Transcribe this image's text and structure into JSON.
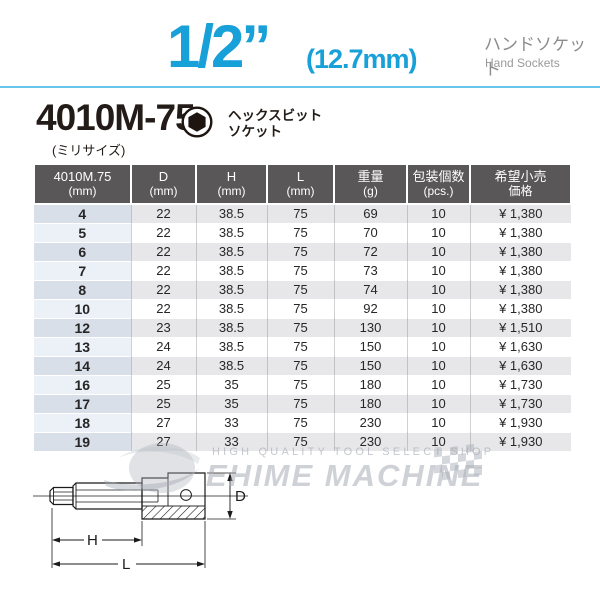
{
  "header": {
    "size_fraction": "1/2”",
    "size_mm": "(12.7mm)",
    "category_jp": "ハンドソケット",
    "category_en": "Hand Sockets",
    "accent_color": "#18a0d8",
    "rule_color": "#67c6ea"
  },
  "product": {
    "model": "4010M-75",
    "variant_note": "(ミリサイズ)",
    "type_line1": "ヘックスビット",
    "type_line2": "ソケット",
    "icon": "hex-bit-icon"
  },
  "table": {
    "header_bg": "#595757",
    "alt_row_color": "#e7e7e9",
    "first_col_colors": [
      "#d8dfe9",
      "#ebf1f7"
    ],
    "headers": [
      {
        "line1": "4010M.75",
        "line2": "(mm)"
      },
      {
        "line1": "D",
        "line2": "(mm)"
      },
      {
        "line1": "H",
        "line2": "(mm)"
      },
      {
        "line1": "L",
        "line2": "(mm)"
      },
      {
        "line1": "重量",
        "line2": "(g)"
      },
      {
        "line1": "包装個数",
        "line2": "(pcs.)"
      },
      {
        "line1": "希望小売",
        "line2": "価格"
      }
    ],
    "rows": [
      [
        "4",
        "22",
        "38.5",
        "75",
        "69",
        "10",
        "¥ 1,380"
      ],
      [
        "5",
        "22",
        "38.5",
        "75",
        "70",
        "10",
        "¥ 1,380"
      ],
      [
        "6",
        "22",
        "38.5",
        "75",
        "72",
        "10",
        "¥ 1,380"
      ],
      [
        "7",
        "22",
        "38.5",
        "75",
        "73",
        "10",
        "¥ 1,380"
      ],
      [
        "8",
        "22",
        "38.5",
        "75",
        "74",
        "10",
        "¥ 1,380"
      ],
      [
        "10",
        "22",
        "38.5",
        "75",
        "92",
        "10",
        "¥ 1,380"
      ],
      [
        "12",
        "23",
        "38.5",
        "75",
        "130",
        "10",
        "¥ 1,510"
      ],
      [
        "13",
        "24",
        "38.5",
        "75",
        "150",
        "10",
        "¥ 1,630"
      ],
      [
        "14",
        "24",
        "38.5",
        "75",
        "150",
        "10",
        "¥ 1,630"
      ],
      [
        "16",
        "25",
        "35",
        "75",
        "180",
        "10",
        "¥ 1,730"
      ],
      [
        "17",
        "25",
        "35",
        "75",
        "180",
        "10",
        "¥ 1,730"
      ],
      [
        "18",
        "27",
        "33",
        "75",
        "230",
        "10",
        "¥ 1,930"
      ],
      [
        "19",
        "27",
        "33",
        "75",
        "230",
        "10",
        "¥ 1,930"
      ]
    ]
  },
  "watermark": {
    "tagline": "HIGH QUALITY TOOL SELECT SHOP",
    "brand": "EHIME MACHINE"
  },
  "diagram": {
    "dim_d": "D",
    "dim_h": "H",
    "dim_l": "L"
  }
}
